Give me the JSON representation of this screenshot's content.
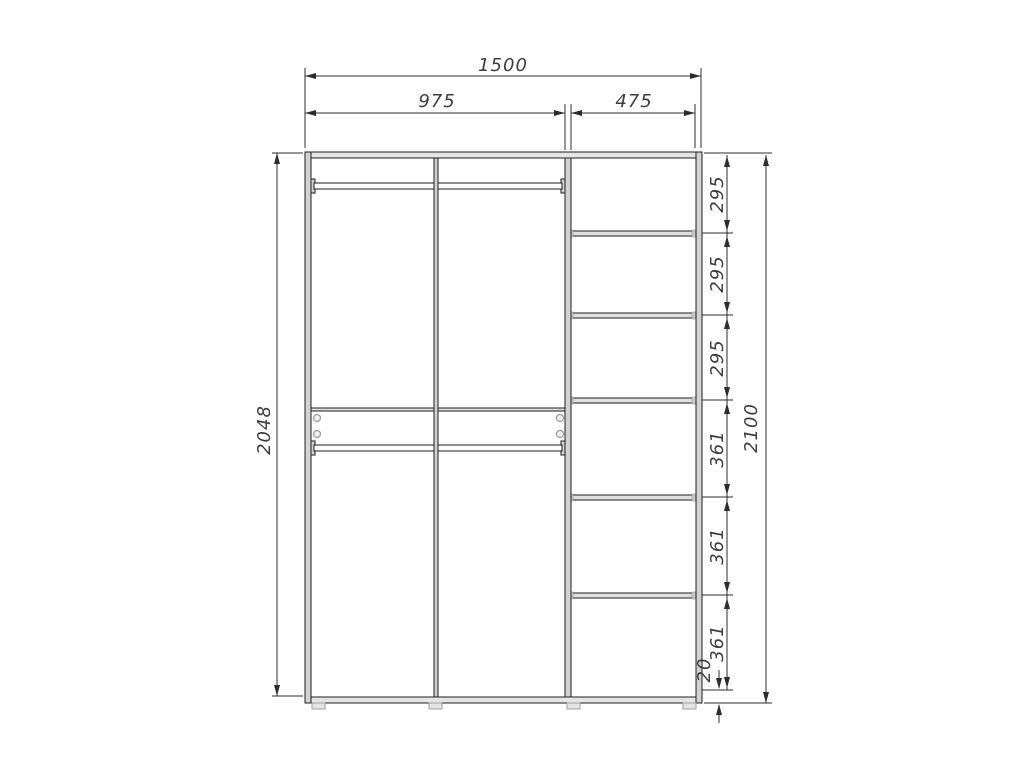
{
  "dimensions": {
    "total_width": "1500",
    "left_width": "975",
    "right_width": "475",
    "left_height": "2048",
    "total_height": "2100",
    "bottom_offset": "20",
    "right_shelf_gaps": [
      "295",
      "295",
      "295",
      "361",
      "361",
      "361"
    ]
  }
}
